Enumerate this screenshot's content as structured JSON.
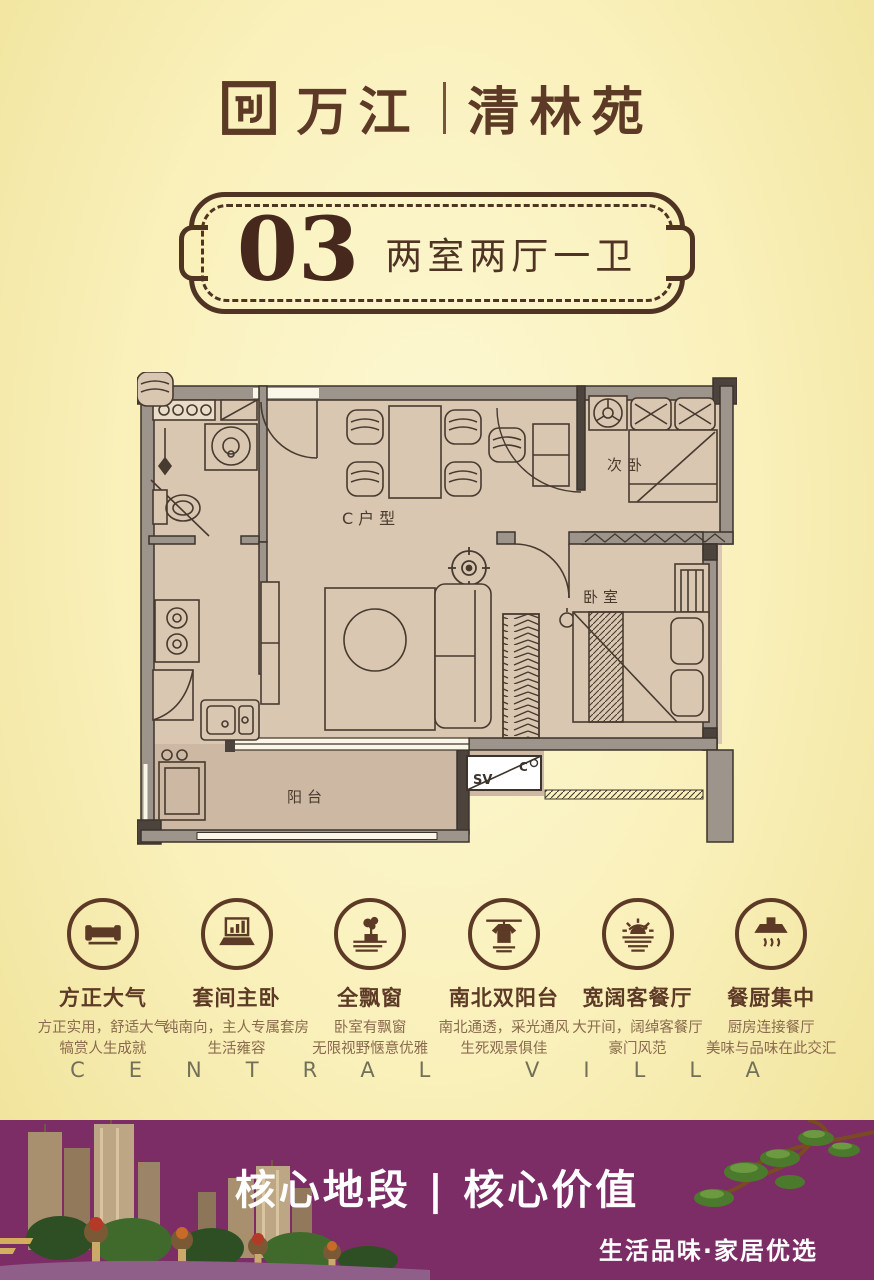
{
  "brand": {
    "name_left": "万江",
    "divider": "|",
    "name_right": "清林苑"
  },
  "badge": {
    "number": "03",
    "layout_label": "两室两厅一卫"
  },
  "floorplan": {
    "unit_label": "C户型",
    "rooms": {
      "secondary_bedroom": "次卧",
      "master_bedroom": "卧室",
      "balcony": "阳台"
    },
    "ac_box": {
      "left": "SV",
      "right": "C"
    }
  },
  "features": [
    {
      "icon": "sofa-icon",
      "title": "方正大气",
      "line1": "方正实用，舒适大气",
      "line2": "犒赏人生成就"
    },
    {
      "icon": "laptop-chart-icon",
      "title": "套间主卧",
      "line1": "纯南向，主人专属套房",
      "line2": "生活雍容"
    },
    {
      "icon": "bay-window-plant-icon",
      "title": "全飘窗",
      "line1": "卧室有飘窗",
      "line2": "无限视野惬意优雅"
    },
    {
      "icon": "hanging-shirt-icon",
      "title": "南北双阳台",
      "line1": "南北通透，采光通风",
      "line2": "生死观景俱佳"
    },
    {
      "icon": "sunrise-icon",
      "title": "宽阔客餐厅",
      "line1": "大开间，阔绰客餐厅",
      "line2": "豪门风范"
    },
    {
      "icon": "range-hood-icon",
      "title": "餐厨集中",
      "line1": "厨房连接餐厅",
      "line2": "美味与品味在此交汇"
    }
  ],
  "watermark": "CENTRAL VILLA",
  "footer": {
    "headline": "核心地段 | 核心价值",
    "tagline": "生活品味·家居优选"
  },
  "colors": {
    "accent_brown": "#5d3a26",
    "banner_purple": "#7c2d66",
    "background": "#f9f0ba",
    "wall_gray": "#9d958c",
    "floor_beige": "#d9c7b2"
  }
}
